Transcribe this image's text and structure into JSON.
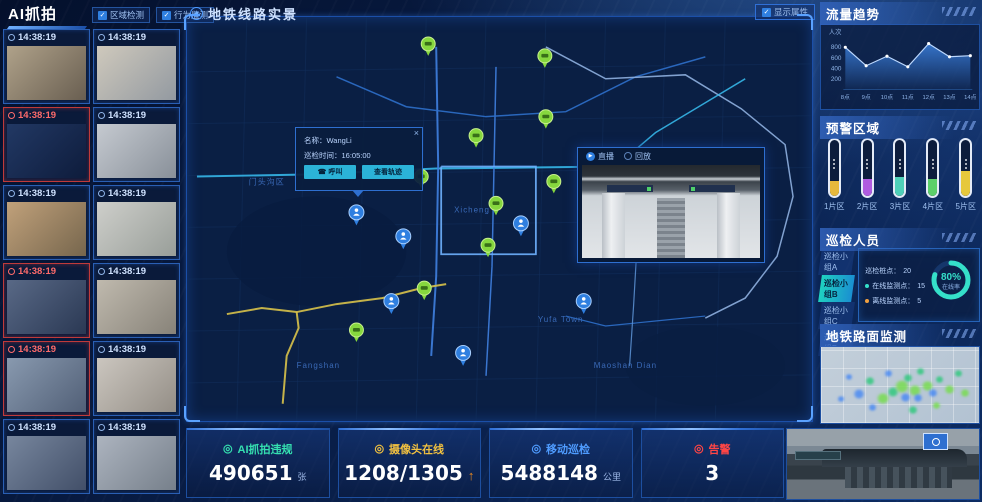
{
  "left_panel": {
    "title": "AI抓拍",
    "filters": [
      {
        "label": "区域检测",
        "checked": true
      },
      {
        "label": "行为监测",
        "checked": true
      }
    ],
    "snapshots": [
      {
        "time": "14:38:19",
        "alert": false,
        "tone": [
          "#b8a98e",
          "#6e6252"
        ]
      },
      {
        "time": "14:38:19",
        "alert": false,
        "tone": [
          "#d9d2c3",
          "#9aa0a6"
        ]
      },
      {
        "time": "14:38:19",
        "alert": true,
        "tone": [
          "#233a66",
          "#0e1c3c"
        ]
      },
      {
        "time": "14:38:19",
        "alert": false,
        "tone": [
          "#cfd3d8",
          "#8f969e"
        ]
      },
      {
        "time": "14:38:19",
        "alert": false,
        "tone": [
          "#caa87e",
          "#7c6a4e"
        ]
      },
      {
        "time": "14:38:19",
        "alert": false,
        "tone": [
          "#d8d8d2",
          "#a0a59e"
        ]
      },
      {
        "time": "14:38:19",
        "alert": true,
        "tone": [
          "#5d6d8a",
          "#2c3a55"
        ]
      },
      {
        "time": "14:38:19",
        "alert": false,
        "tone": [
          "#c9c2b4",
          "#8e887c"
        ]
      },
      {
        "time": "14:38:19",
        "alert": true,
        "tone": [
          "#8fa0b5",
          "#55637a"
        ]
      },
      {
        "time": "14:38:19",
        "alert": false,
        "tone": [
          "#d5cfc6",
          "#9b948a"
        ]
      },
      {
        "time": "14:38:19",
        "alert": false,
        "tone": [
          "#7d8ca3",
          "#45526b"
        ]
      },
      {
        "time": "14:38:19",
        "alert": false,
        "tone": [
          "#b5bcc6",
          "#7c858f"
        ]
      }
    ]
  },
  "map_panel": {
    "title": "地铁线路实景",
    "display_toggle": {
      "label": "显示属性",
      "checked": true
    },
    "popup": {
      "name_label": "名称：",
      "name": "WangLi",
      "time_label": "巡检时间：",
      "time": "16:05:00",
      "call_button": "呼叫",
      "track_button": "查看轨迹",
      "close_glyph": "×"
    },
    "video": {
      "live_label": "直播",
      "replay_label": "回放",
      "live_selected": true
    },
    "district_labels": [
      "门头沟区",
      "Xicheng",
      "Fangshan",
      "Yufa Town",
      "Maoshan Dian"
    ]
  },
  "right_panel": {
    "traffic_title": "流量趋势",
    "warning": {
      "title": "预警区域",
      "gauges": [
        {
          "label": "1片区",
          "color": "#e6b83c",
          "level": 26
        },
        {
          "label": "2片区",
          "color": "#b05ce0",
          "level": 30
        },
        {
          "label": "3片区",
          "color": "#4fd0b8",
          "level": 34
        },
        {
          "label": "4片区",
          "color": "#5cd06a",
          "level": 30
        },
        {
          "label": "5片区",
          "color": "#e6c83c",
          "level": 44
        }
      ]
    },
    "patrol": {
      "title": "巡检人员",
      "groups": [
        {
          "label": "巡检小组A",
          "selected": false
        },
        {
          "label": "巡检小组B",
          "selected": true
        },
        {
          "label": "巡检小组C",
          "selected": false
        },
        {
          "label": "巡检小组D",
          "selected": false
        }
      ],
      "piles_label": "巡检桩点：",
      "piles_value": "20",
      "online_label": "在线监测点：",
      "online_value": "15",
      "offline_label": "离线监测点：",
      "offline_value": "5",
      "rate_value": "80%",
      "rate_label": "在线率"
    },
    "road_title": "地铁路面监测"
  },
  "stats_bar": [
    {
      "key": "ai-violations",
      "label": "AI抓拍违规",
      "value": "490651",
      "unit": "张",
      "color": "#35e0b0"
    },
    {
      "key": "cameras-online",
      "label": "摄像头在线",
      "value": "1208/1305",
      "unit": "↑",
      "color": "#f0c040",
      "unit_color": "#f08c1e"
    },
    {
      "key": "mobile-patrol",
      "label": "移动巡检",
      "value": "5488148",
      "unit": "公里",
      "color": "#4f9cff"
    },
    {
      "key": "alerts",
      "label": "告警",
      "value": "3",
      "unit": "",
      "color": "#ff4545"
    }
  ],
  "chart_data": {
    "type": "area",
    "title": "流量趋势",
    "x": [
      "8点",
      "9点",
      "10点",
      "11点",
      "12点",
      "13点",
      "14点"
    ],
    "values": [
      800,
      450,
      630,
      430,
      870,
      620,
      640
    ],
    "ylabel": "人次",
    "yticks": [
      200,
      400,
      600,
      800
    ],
    "ylim": [
      0,
      1000
    ],
    "grid": false,
    "legend": "none"
  }
}
